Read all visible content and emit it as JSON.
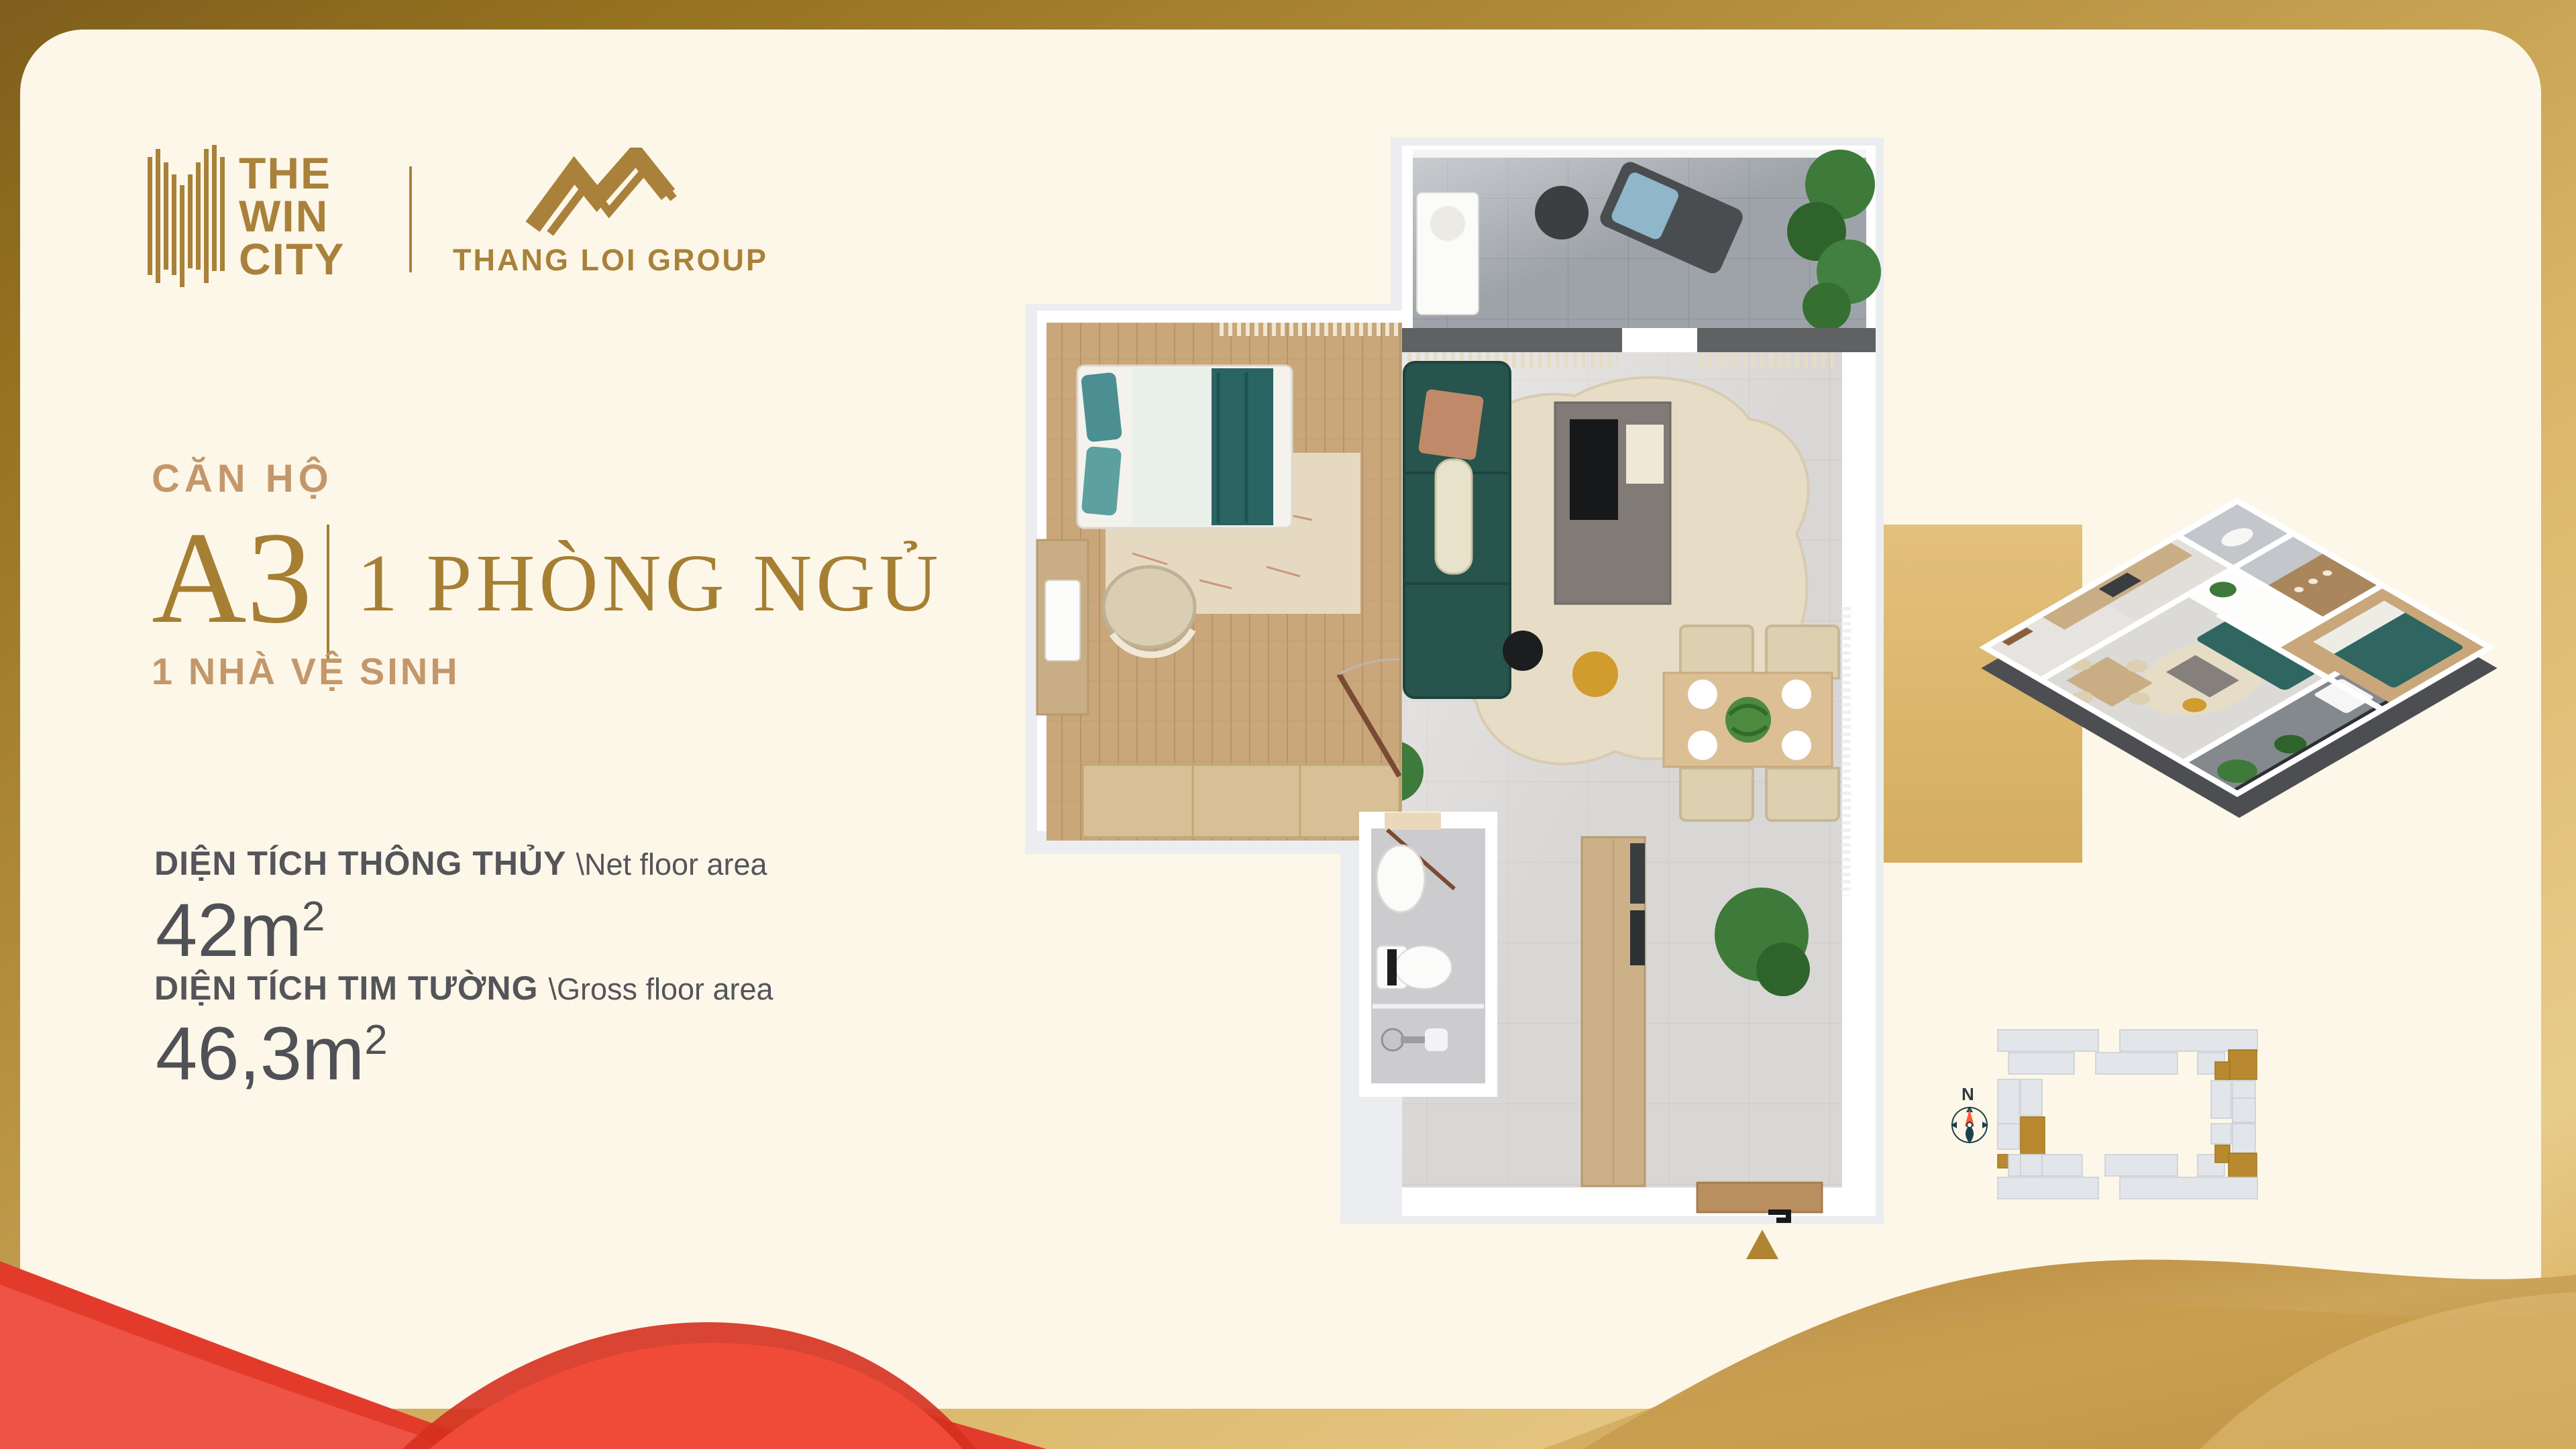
{
  "header": {
    "project": {
      "line1": "THE",
      "line2": "WIN",
      "line3": "CITY"
    },
    "developer": "THANG LOI GROUP"
  },
  "unit": {
    "label": "CĂN HỘ",
    "code": "A3",
    "bedroom": "1 PHÒNG NGỦ",
    "bathroom": "1 NHÀ VỆ SINH"
  },
  "areas": {
    "net": {
      "label": "DIỆN TÍCH THÔNG THỦY",
      "label_en": "\\Net floor area",
      "value": "42m",
      "sup": "2"
    },
    "gross": {
      "label": "DIỆN TÍCH TIM TƯỜNG",
      "label_en": "\\Gross floor area",
      "value": "46,3m",
      "sup": "2"
    }
  },
  "compass": {
    "north_label": "N"
  },
  "icons": {
    "win_city_logo_mark": "vertical-bars-building",
    "thang_loi_logo_mark": "gold-zigzag-mountain",
    "compass_icon": "north-compass",
    "entrance_arrow_icon": "gold-triangle-up"
  },
  "colors": {
    "frame_gold_dark": "#7f5e1d",
    "frame_gold_light": "#e9cc8a",
    "card_cream": "#fcf7e8",
    "brand_gold": "#a9813b",
    "title_tan": "#c4976b",
    "title_gold": "#a67f33",
    "text_dark": "#54555a",
    "accent_band": "#dcba76",
    "entrance_triangle": "#ae8530",
    "red_wave": "#e23b2c",
    "siteplan_unit": "#e2e5e9",
    "siteplan_highlight": "#b8892f",
    "compass_teal": "#1d3f48",
    "compass_orange": "#ff5a36",
    "sofa_teal": "#27544d",
    "wood_floor": "#c9a77b",
    "tile_gray": "#dad8d6",
    "balcony_gray": "#9ea3a9"
  },
  "site_plan": {
    "blocks": [
      [
        80,
        10,
        150,
        32,
        "g"
      ],
      [
        262,
        10,
        205,
        32,
        "g"
      ],
      [
        96,
        44,
        98,
        32,
        "g"
      ],
      [
        226,
        44,
        122,
        32,
        "g"
      ],
      [
        378,
        44,
        40,
        32,
        "g"
      ],
      [
        424,
        40,
        42,
        44,
        "d"
      ],
      [
        404,
        58,
        22,
        26,
        "d"
      ],
      [
        80,
        84,
        32,
        104,
        "g"
      ],
      [
        114,
        84,
        32,
        54,
        "g"
      ],
      [
        114,
        140,
        36,
        62,
        "d"
      ],
      [
        430,
        86,
        34,
        94,
        "g"
      ],
      [
        398,
        86,
        30,
        56,
        "g"
      ],
      [
        80,
        150,
        32,
        38,
        "g"
      ],
      [
        430,
        150,
        34,
        44,
        "g"
      ],
      [
        80,
        196,
        18,
        20,
        "d"
      ],
      [
        96,
        196,
        110,
        32,
        "g"
      ],
      [
        240,
        196,
        108,
        32,
        "g"
      ],
      [
        378,
        196,
        40,
        32,
        "g"
      ],
      [
        404,
        182,
        22,
        26,
        "d"
      ],
      [
        424,
        194,
        42,
        46,
        "d"
      ],
      [
        80,
        230,
        150,
        32,
        "g"
      ],
      [
        262,
        230,
        205,
        32,
        "g"
      ],
      [
        430,
        112,
        34,
        36,
        "g"
      ],
      [
        114,
        196,
        32,
        32,
        "g"
      ],
      [
        398,
        150,
        30,
        30,
        "g"
      ]
    ]
  }
}
